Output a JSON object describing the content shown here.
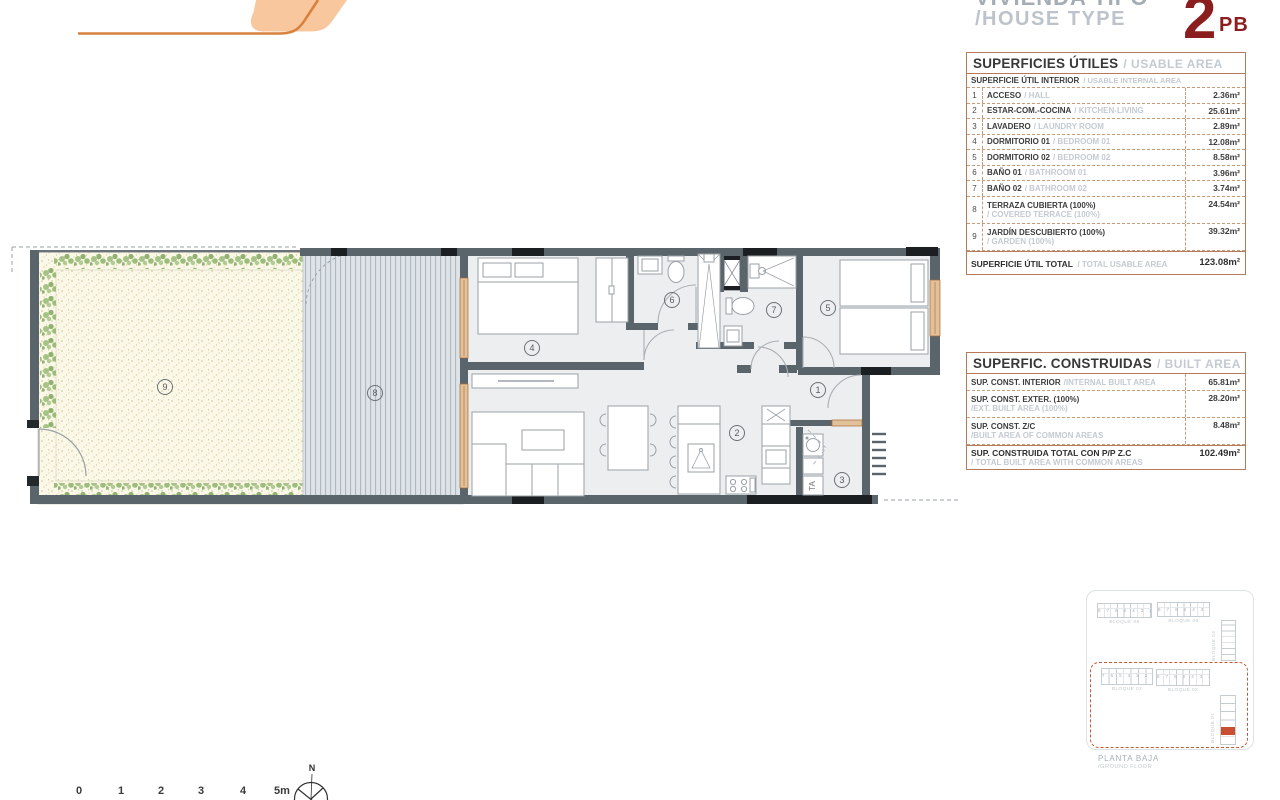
{
  "header": {
    "title_line1": "VIVIENDA TIPO",
    "title_line2": "/HOUSE TYPE",
    "badge_number": "2",
    "badge_suffix": "PB",
    "badge_color": "#8C1D1E"
  },
  "usable_table": {
    "title_es": "SUPERFICIES ÚTILES",
    "title_en": "/ USABLE AREA",
    "subheader_es": "SUPERFICIE ÚTIL INTERIOR",
    "subheader_en": "/ USABLE INTERNAL AREA",
    "rows": [
      {
        "num": "1",
        "es": "ACCESO",
        "en": "/ HALL",
        "value": "2.36m²"
      },
      {
        "num": "2",
        "es": "ESTAR-COM.-COCINA",
        "en": "/ KITCHEN-LIVING",
        "value": "25.61m²"
      },
      {
        "num": "3",
        "es": "LAVADERO",
        "en": "/ LAUNDRY ROOM",
        "value": "2.89m²"
      },
      {
        "num": "4",
        "es": "DORMITORIO 01",
        "en": "/ BEDROOM 01",
        "value": "12.08m²"
      },
      {
        "num": "5",
        "es": "DORMITORIO 02",
        "en": "/ BEDROOM 02",
        "value": "8.58m²"
      },
      {
        "num": "6",
        "es": "BAÑO 01",
        "en": "/ BATHROOM 01",
        "value": "3.96m²"
      },
      {
        "num": "7",
        "es": "BAÑO 02",
        "en": "/ BATHROOM 02",
        "value": "3.74m²"
      },
      {
        "num": "8",
        "es": "TERRAZA CUBIERTA (100%)",
        "en": "/ COVERED TERRACE (100%)",
        "value": "24.54m²"
      },
      {
        "num": "9",
        "es": "JARDÍN DESCUBIERTO (100%)",
        "en": "/ GARDEN (100%)",
        "value": "39.32m²"
      }
    ],
    "total_es": "SUPERFICIE ÚTIL TOTAL",
    "total_en": "/ TOTAL USABLE AREA",
    "total_value": "123.08m²"
  },
  "built_table": {
    "title_es": "SUPERFIC. CONSTRUIDAS",
    "title_en": "/ BUILT AREA",
    "rows": [
      {
        "es": "SUP. CONST. INTERIOR",
        "en": "/INTERNAL BUILT AREA",
        "value": "65.81m²"
      },
      {
        "es": "SUP. CONST. EXTER. (100%)",
        "en": "/EXT. BUILT AREA (100%)",
        "value": "28.20m²"
      },
      {
        "es": "SUP. CONST. Z/C",
        "en": "/BUILT AREA OF COMMON AREAS",
        "value": "8.48m²"
      }
    ],
    "total_es": "SUP. CONSTRUIDA TOTAL CON P/P Z.C",
    "total_en": "/ TOTAL BUILT AREA WITH COMMON AREAS",
    "total_value": "102.49m²"
  },
  "plan": {
    "labels": {
      "l1": "1",
      "l2": "2",
      "l3": "3",
      "l4": "4",
      "l5": "5",
      "l6": "6",
      "l7": "7",
      "l8": "8",
      "l9": "9"
    },
    "ta_label": "TA",
    "wall_color": "#59646B",
    "terrace_color": "#DDE3E6",
    "garden_color": "#FBF8E8",
    "hedge_color": "#9CBC7C",
    "window_color": "#E2C19A"
  },
  "scale_bar": {
    "ticks": [
      "0",
      "1",
      "2",
      "3",
      "4",
      "5m"
    ]
  },
  "compass": {
    "north_label": "N"
  },
  "sitemap": {
    "block06_label": "BLOQUE 06",
    "block06_digits": "8 7 6 5 4 3 2 1",
    "block05_label": "BLOQUE 05",
    "block05_digits": "8 7 6 5 4 3 2 1",
    "block04_label": "BLOQUE 04",
    "block03_label": "BLOQUE 03",
    "block03_digits": "7 6 5 4 3 2 1",
    "block02_label": "BLOQUE 02",
    "block02_digits": "8 7 6 5 4 3 2 1",
    "block01_label": "BLOQUE 01",
    "highlight_color": "#C94F32",
    "floor_es": "PLANTA BAJA",
    "floor_en": "/GROUND FLOOR"
  }
}
